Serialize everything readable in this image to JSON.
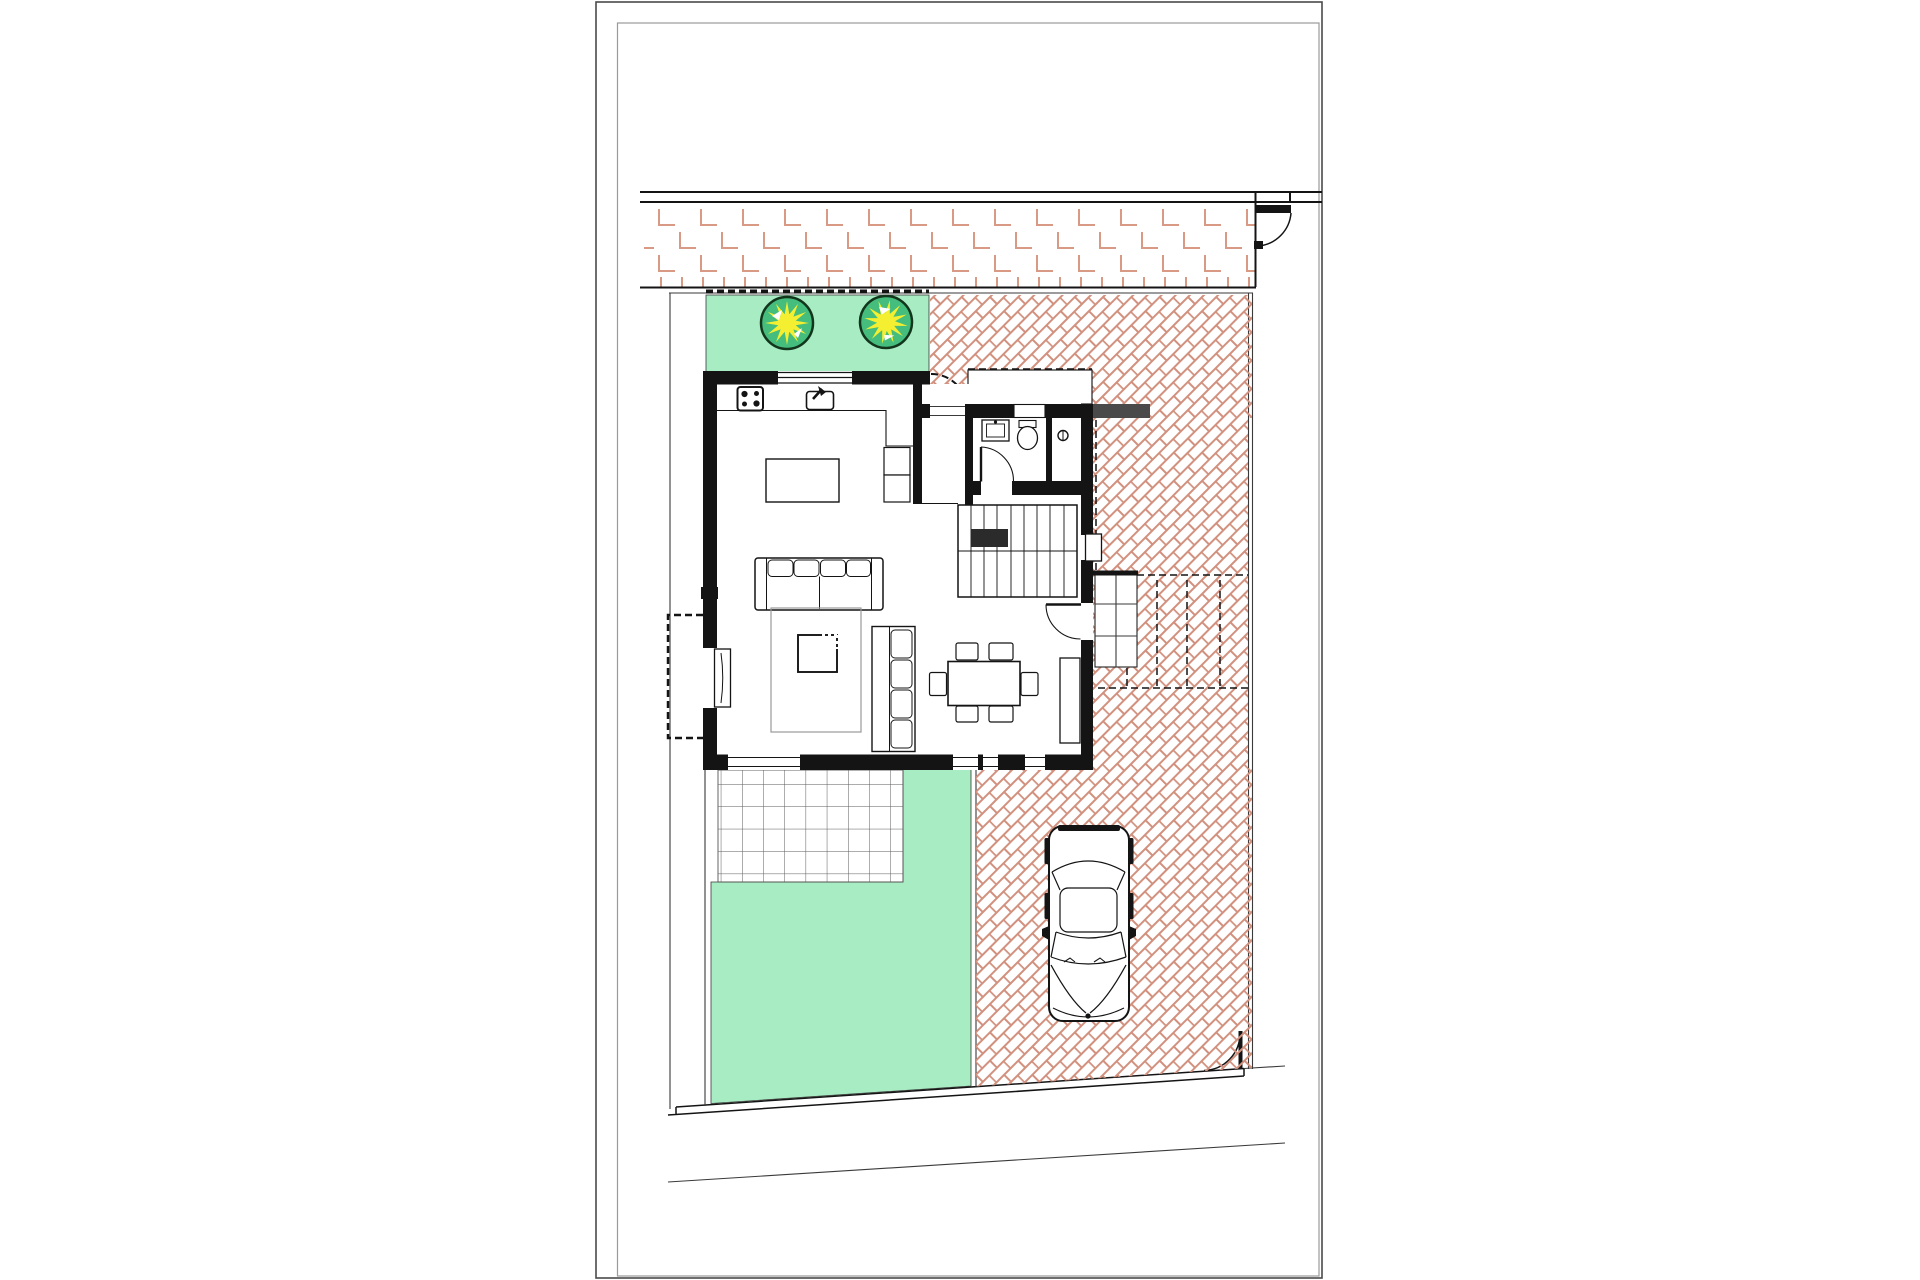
{
  "document": {
    "kind": "architectural-site-plan",
    "sheet": "portrait-sheet-with-inner-frame",
    "visible_text": ""
  },
  "colors": {
    "page-bg": "#ffffff",
    "frame-outer": "#4a4a4a",
    "frame-inner": "#9a9a9a",
    "line-dark": "#141414",
    "line-medium": "#3a3a3a",
    "paving": "#d2917e",
    "paving-light": "#d89a85",
    "grass": "#a7ecc2",
    "tree-ring": "#12351c",
    "tree-fill": "#45bd7d",
    "tree-burst": "#f4ef31",
    "tile-line": "#5a5a5a",
    "rug-line": "#9a9a9a",
    "wall-stub": "#4a4a4a"
  },
  "plan": {
    "site": {
      "regions": [
        "brick-sidewalk",
        "front-lawn",
        "herringbone-driveway",
        "tiled-patio",
        "back-lawn",
        "sloped-street-edge"
      ],
      "tree_count": 2,
      "gates": [
        "street-gate-top-right",
        "pedestrian-gate-bottom-right"
      ],
      "dashed_overlays": [
        "entry-gate-swing",
        "side-balcony-above",
        "carport-canopy-above"
      ]
    },
    "house": {
      "rooms": [
        "kitchen-living-room",
        "entry-hall",
        "bathroom",
        "staircase"
      ],
      "fixtures": [
        "stove",
        "kitchen-sink",
        "washbasin",
        "toilet",
        "shower"
      ],
      "furniture": [
        "kitchen-island",
        "tall-cabinets",
        "sofa",
        "rug",
        "coffee-table",
        "armchair",
        "dining-table",
        "dining-chairs",
        "sideboard"
      ],
      "doors": [
        "bathroom-door",
        "terrace-door",
        "entry-door"
      ],
      "windows": [
        "kitchen-window",
        "side-window-left",
        "side-window-right",
        "south-glazing"
      ]
    },
    "vehicles": [
      "parked-car"
    ]
  }
}
